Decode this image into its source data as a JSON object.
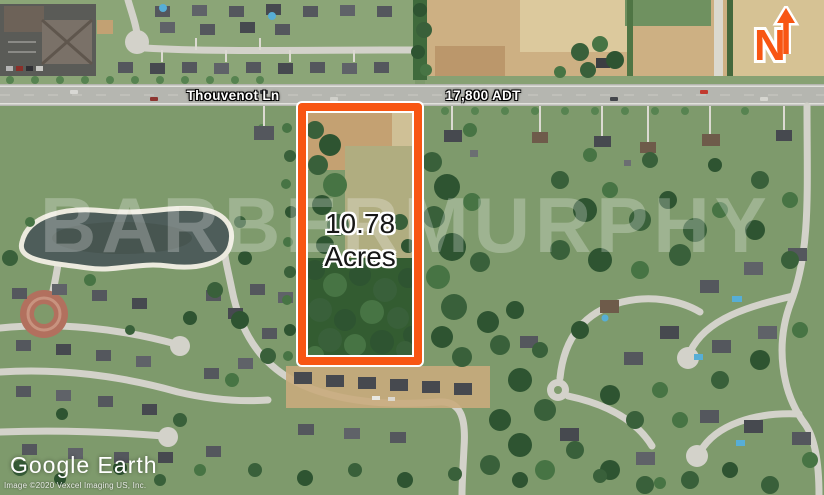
{
  "annotations": {
    "road_label": "Thouvenot Ln",
    "traffic_count": "17,800 ADT",
    "acreage_value": "10.78",
    "acreage_unit": "Acres",
    "watermark": "BARBERMURPHY",
    "north_letter": "N"
  },
  "attribution": {
    "logo": "Google Earth",
    "copyright": "Image ©2020 Vexcel Imaging US, Inc."
  },
  "colors": {
    "parcel_outline_orange": "#F85613",
    "annotation_outline_white": "#FFFFFF",
    "road_label_text": "#FFFFFF",
    "acreage_text": "#161616"
  }
}
